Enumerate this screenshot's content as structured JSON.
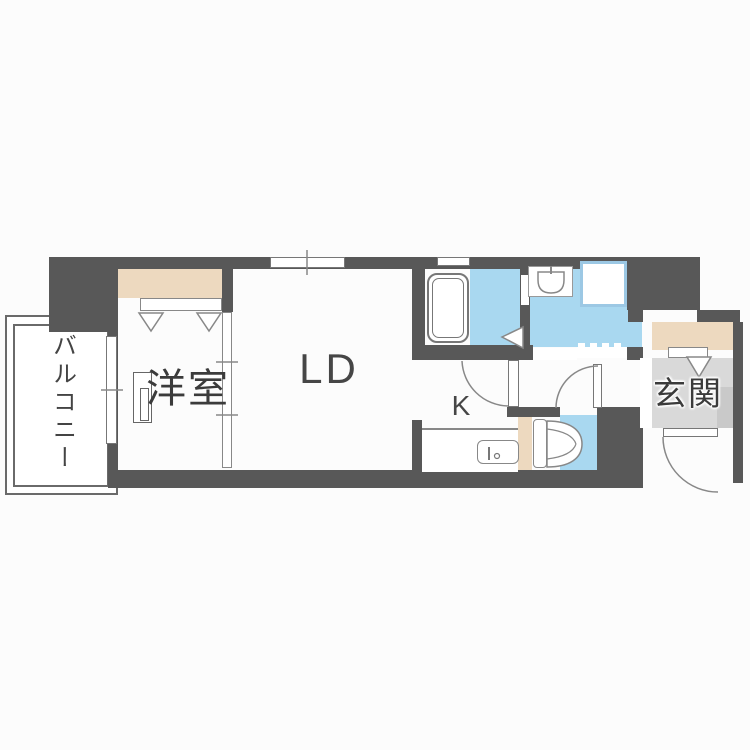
{
  "title": "apartment-floor-plan",
  "colors": {
    "wall": "#585858",
    "water": "#a9d8f0",
    "beige": "#edd9bf",
    "genkan": "#d9d9d9",
    "genkan_step": "#c9c9c9",
    "line": "#888888",
    "text": "#3b3b3b",
    "washer_border": "#9cc8e4",
    "bg": "#fcfcfc"
  },
  "rooms": {
    "balcony": {
      "label": "バルコニー"
    },
    "western_room": {
      "label": "洋室"
    },
    "living_dining": {
      "label": "LD"
    },
    "kitchen": {
      "label": "K"
    },
    "entrance": {
      "label": "玄関"
    }
  },
  "icons": {
    "bathtub": "bathtub-icon (css shape)",
    "washbasin": "washbasin-icon (svg bowl with tap)",
    "washing_machine": "washing-machine-pan-icon (blue-bordered square)",
    "toilet": "toilet-icon (tank + bowl svg)",
    "kitchen_sink": "kitchen-sink-icon (rounded rect with faucet)"
  }
}
